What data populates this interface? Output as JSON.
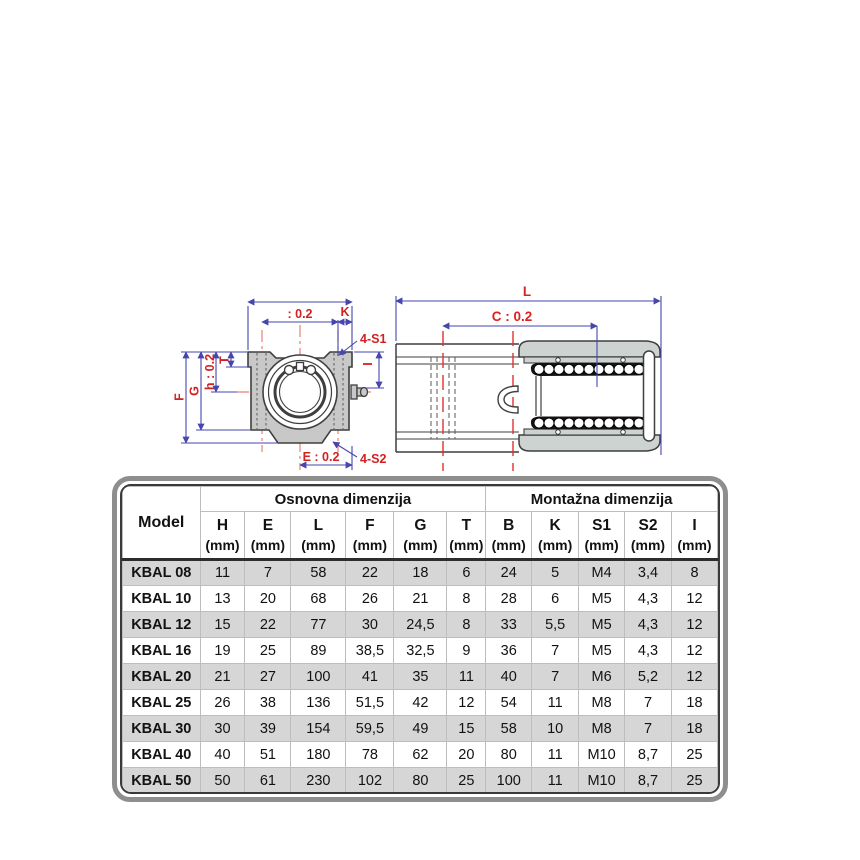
{
  "drawing": {
    "front_view": {
      "top_width_tolerance": ": 0.2",
      "k": "K",
      "screws_top": "4-S1",
      "screws_bottom": "4-S2",
      "e": "E : 0.2",
      "i": "I",
      "t": "T",
      "h": "h : 0.2",
      "g": "G",
      "f": "F"
    },
    "side_view": {
      "l": "L",
      "c": "C : 0.2"
    },
    "colors": {
      "dimension_line": "#4646ac",
      "dimension_text": "#d42020",
      "centerline": "#e8836f",
      "section_centerline": "#e03030",
      "body_fill": "#c8c8c8",
      "cap_fill": "#ccd3d0",
      "outline": "#3f3f3f"
    }
  },
  "table": {
    "model_header": "Model",
    "group_basic": "Osnovna dimenzija",
    "group_mounting": "Montažna dimenzija",
    "unit": "(mm)",
    "columns": [
      "H",
      "E",
      "L",
      "F",
      "G",
      "T",
      "B",
      "K",
      "S1",
      "S2",
      "I"
    ],
    "rows": [
      {
        "model": "KBAL 08",
        "values": [
          "11",
          "7",
          "58",
          "22",
          "18",
          "6",
          "24",
          "5",
          "M4",
          "3,4",
          "8"
        ]
      },
      {
        "model": "KBAL 10",
        "values": [
          "13",
          "20",
          "68",
          "26",
          "21",
          "8",
          "28",
          "6",
          "M5",
          "4,3",
          "12"
        ]
      },
      {
        "model": "KBAL 12",
        "values": [
          "15",
          "22",
          "77",
          "30",
          "24,5",
          "8",
          "33",
          "5,5",
          "M5",
          "4,3",
          "12"
        ]
      },
      {
        "model": "KBAL 16",
        "values": [
          "19",
          "25",
          "89",
          "38,5",
          "32,5",
          "9",
          "36",
          "7",
          "M5",
          "4,3",
          "12"
        ]
      },
      {
        "model": "KBAL 20",
        "values": [
          "21",
          "27",
          "100",
          "41",
          "35",
          "11",
          "40",
          "7",
          "M6",
          "5,2",
          "12"
        ]
      },
      {
        "model": "KBAL 25",
        "values": [
          "26",
          "38",
          "136",
          "51,5",
          "42",
          "12",
          "54",
          "11",
          "M8",
          "7",
          "18"
        ]
      },
      {
        "model": "KBAL 30",
        "values": [
          "30",
          "39",
          "154",
          "59,5",
          "49",
          "15",
          "58",
          "10",
          "M8",
          "7",
          "18"
        ]
      },
      {
        "model": "KBAL 40",
        "values": [
          "40",
          "51",
          "180",
          "78",
          "62",
          "20",
          "80",
          "11",
          "M10",
          "8,7",
          "25"
        ]
      },
      {
        "model": "KBAL 50",
        "values": [
          "50",
          "61",
          "230",
          "102",
          "80",
          "25",
          "100",
          "11",
          "M10",
          "8,7",
          "25"
        ]
      }
    ]
  }
}
